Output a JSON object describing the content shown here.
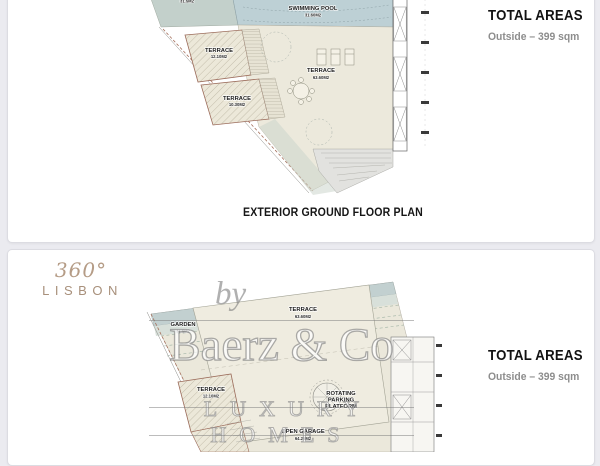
{
  "colors": {
    "page_background": "#ebebf0",
    "card_background": "#ffffff",
    "pool_blue": "#bdd0d5",
    "ground_beige": "#ece9dc",
    "band_teal": "#c3d0cf",
    "terrace_outline": "#9b6b5a",
    "logo_tan": "#b09a85",
    "watermark_gray": "#7a7a7a"
  },
  "gallery": {
    "panels": [
      {
        "title": "EXTERIOR GROUND FLOOR PLAN",
        "totals": {
          "title": "TOTAL AREAS",
          "outside": "Outside – 399 sqm"
        },
        "labels": {
          "garden_partial_name": "GARDEN",
          "garden_partial_area": "31.5M2",
          "swimming_pool_name": "SWIMMING POOL",
          "swimming_pool_area": "31.60M2",
          "terrace_upper_name": "TERRACE",
          "terrace_upper_area": "12.10M2",
          "terrace_lower_name": "TERRACE",
          "terrace_lower_area": "10.30M2",
          "terrace_main_name": "TERRACE",
          "terrace_main_area": "63.60M2"
        }
      },
      {
        "logo": {
          "top": "360°",
          "bottom": "LISBON"
        },
        "watermark": {
          "by": "by",
          "brand": "Baerz & Co",
          "tagline": "LUXURY HOMES"
        },
        "totals": {
          "title": "TOTAL AREAS",
          "outside": "Outside – 399 sqm"
        },
        "labels": {
          "garden_name": "GARDEN",
          "garden_area": "31.5M2",
          "terrace_main_name": "TERRACE",
          "terrace_main_area": "63.60M2",
          "terrace_left_name": "TERRACE",
          "terrace_left_area": "12.10M2",
          "rotating_line1": "ROTATING",
          "rotating_line2": "PARKING",
          "rotating_line3": "PLATFORM",
          "open_garage_name": "OPEN GARAGE",
          "open_garage_area": "64.25M2"
        }
      }
    ]
  }
}
